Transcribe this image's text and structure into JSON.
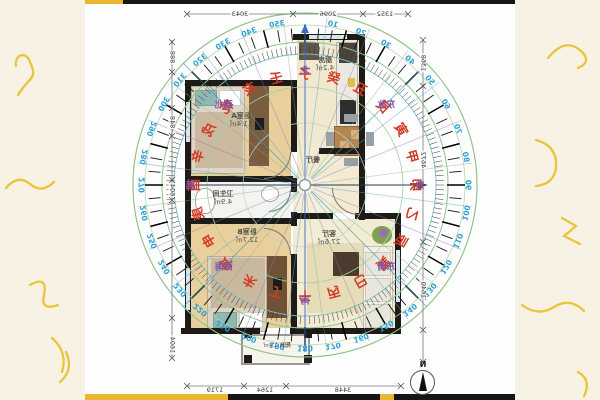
{
  "colors": {
    "page_bg": "#f7f2e3",
    "panel_bg": "#fefefe",
    "wall": "#1d1b18",
    "wood_floor": "#e9cf9b",
    "tile_floor": "#f3f3ef",
    "living_floor": "#f2ecd4",
    "ring_green": "#8fc48a",
    "ring_teal": "#7fc3bd",
    "degree_blue": "#2aa0d6",
    "mountain_red": "#d23a26",
    "direction_purple": "#7b57ae",
    "accent_yellow": "#eab82f"
  },
  "rooms": {
    "bedroomA": {
      "name": "卧室A",
      "area": "11.4㎡"
    },
    "kitchen": {
      "name": "厨房",
      "area": "4.2㎡"
    },
    "dining": {
      "name": "餐厅",
      "area": ""
    },
    "bathroom": {
      "name": "卫生间",
      "area": "4.9㎡"
    },
    "bedroomB": {
      "name": "卧室B",
      "area": "12.7㎡"
    },
    "living": {
      "name": "客厅",
      "area": "27.6㎡"
    },
    "balcony": {
      "name": "阳台",
      "area": "1.4㎡"
    }
  },
  "dimensions": {
    "top": [
      "1352",
      "2096",
      "3043"
    ],
    "bottom": [
      "3448",
      "1264",
      "1719"
    ],
    "left": [
      "888",
      "848",
      "604",
      "1604"
    ],
    "right": [
      "1368",
      "4672",
      "1640"
    ]
  },
  "north_label": "N",
  "compass": {
    "degrees": [
      10,
      20,
      30,
      40,
      50,
      60,
      70,
      80,
      90,
      100,
      110,
      120,
      130,
      140,
      150,
      160,
      170,
      180,
      190,
      200,
      210,
      220,
      230,
      240,
      250,
      260,
      270,
      280,
      290,
      300,
      310,
      320,
      330,
      340,
      350
    ],
    "mountains": [
      "子",
      "癸",
      "丑",
      "艮",
      "寅",
      "甲",
      "卯",
      "乙",
      "辰",
      "巽",
      "巳",
      "丙",
      "午",
      "丁",
      "未",
      "坤",
      "申",
      "庚",
      "酉",
      "辛",
      "戌",
      "乾",
      "亥",
      "壬"
    ],
    "directions": [
      {
        "label": "北",
        "deg": 0
      },
      {
        "label": "东北",
        "deg": 45
      },
      {
        "label": "东",
        "deg": 90
      },
      {
        "label": "东南",
        "deg": 135
      },
      {
        "label": "南",
        "deg": 180
      },
      {
        "label": "西南",
        "deg": 225
      },
      {
        "label": "西",
        "deg": 270
      },
      {
        "label": "西北",
        "deg": 315
      }
    ]
  }
}
